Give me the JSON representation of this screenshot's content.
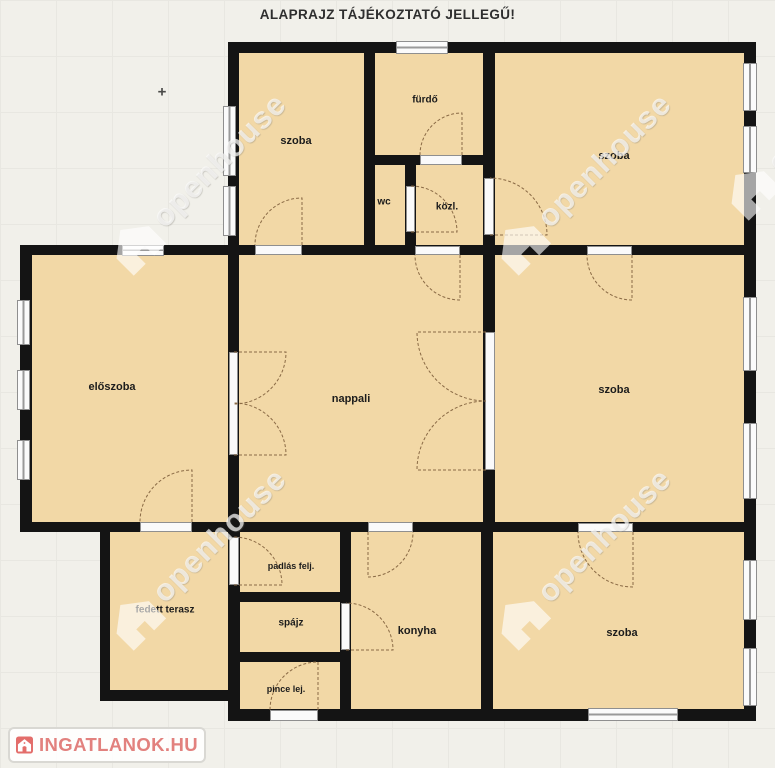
{
  "title": "ALAPRAJZ TÁJÉKOZTATÓ JELLEGŰ!",
  "marker": {
    "cross": "+"
  },
  "rooms": {
    "szoba_top_left": "szoba",
    "furdo": "fürdő",
    "wc": "wc",
    "kozl": "közl.",
    "szoba_top_right": "szoba",
    "eloszoba": "előszoba",
    "nappali": "nappali",
    "szoba_right": "szoba",
    "fedett_terasz": "fedett terasz",
    "padlas_felj": "padlás felj.",
    "spajz": "spájz",
    "konyha": "konyha",
    "pince_lej": "pince lej.",
    "szoba_bottom_right": "szoba"
  },
  "watermark": {
    "text": "openhouse"
  },
  "logo": {
    "text": "INGATLANOK.HU",
    "accent_color": "#e2817e"
  },
  "colors": {
    "room_fill": "#f2d8a6",
    "wall": "#141414",
    "background": "#f1f0ea",
    "opening": "#fafafa"
  }
}
